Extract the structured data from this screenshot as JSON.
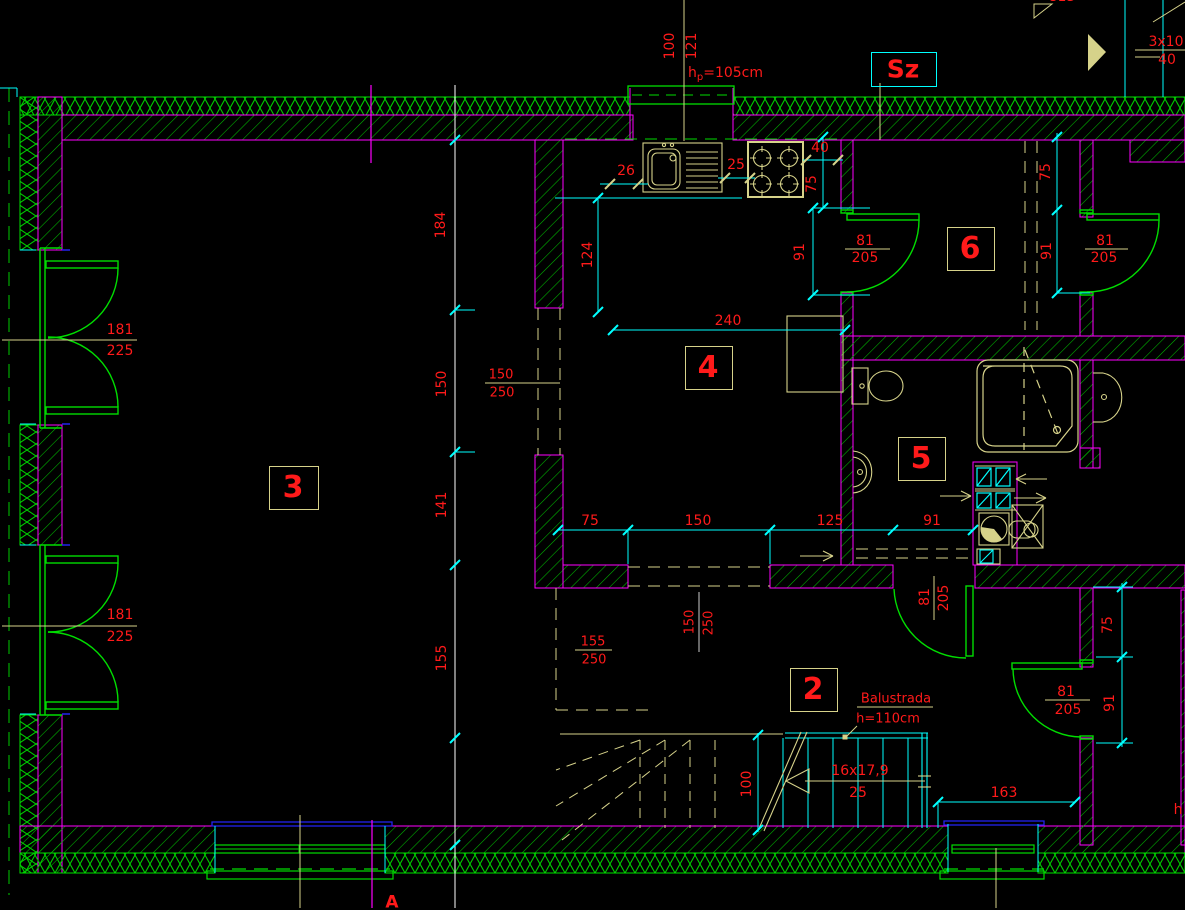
{
  "title": "floor-plan",
  "colors": {
    "background": "#000000",
    "wall_green": "#00dd00",
    "hatch_green": "#00bb00",
    "magenta": "#ff00ff",
    "cyan": "#00ffff",
    "dim_red": "#ff1a1a",
    "annotation_yellow": "#d6d28a",
    "sill_blue": "#2222ee",
    "white": "#ffffff"
  },
  "rooms": {
    "r2": "2",
    "r3": "3",
    "r4": "4",
    "r5": "5",
    "r6": "6"
  },
  "markers": {
    "shaft": "Sz",
    "section": "A",
    "roof_top": "3x10",
    "roof_bottom": "40",
    "clip_top": "813",
    "clip_right": "h"
  },
  "window_note": {
    "prefix": "h",
    "sub": "p",
    "value": "=105cm"
  },
  "balustrade": {
    "line1": "Balustrada",
    "line2": "h=110cm"
  },
  "stair_note": {
    "top": "16x17,9",
    "bottom": "25"
  },
  "door_labels": {
    "balcony1": {
      "w": "181",
      "h": "225"
    },
    "balcony2": {
      "w": "181",
      "h": "225"
    },
    "d6l": {
      "w": "81",
      "h": "205"
    },
    "d6r": {
      "w": "81",
      "h": "205"
    },
    "d2": {
      "w": "81",
      "h": "205"
    },
    "dbr": {
      "w": "81",
      "h": "205"
    }
  },
  "lintels": {
    "mid": {
      "w": "150",
      "h": "250"
    },
    "low": {
      "w": "155",
      "h": "250"
    },
    "vert": {
      "w": "150",
      "h": "250"
    }
  },
  "dims": {
    "left_chain": [
      "184",
      "150",
      "141",
      "155"
    ],
    "mid_chain": [
      "75",
      "150",
      "125",
      "91"
    ],
    "top": [
      "100",
      "121"
    ],
    "kitchen": {
      "a": "26",
      "b": "25",
      "c": "40",
      "d": "75"
    },
    "room4": {
      "a": "124",
      "b": "240",
      "c": "91"
    },
    "room6": {
      "a": "75",
      "b": "91"
    },
    "corridor": {
      "a": "75",
      "b": "91"
    },
    "stair": "100",
    "bottom_right": "163"
  }
}
